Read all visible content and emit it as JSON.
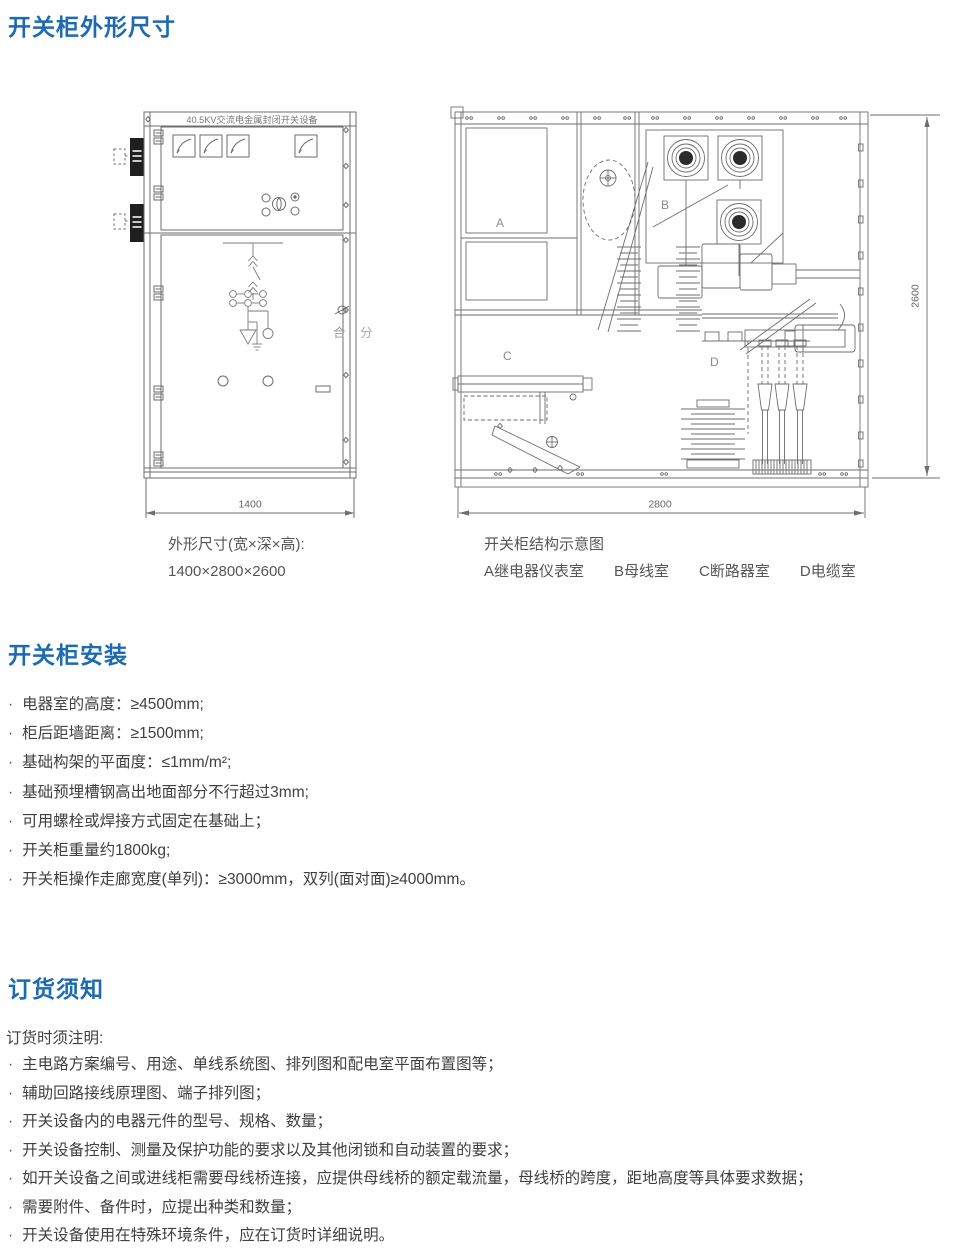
{
  "titles": {
    "outline": "开关柜外形尺寸",
    "installation": "开关柜安装",
    "ordering": "订货须知"
  },
  "bullets": {
    "dot": "·"
  },
  "front_view": {
    "nameplate": "40.5KV交流电金属封闭开关设备",
    "close_label": "合",
    "open_label": "分",
    "width_dim": "1400",
    "caption_line1": "外形尺寸(宽×深×高):",
    "caption_line2": "1400×2800×2600"
  },
  "section_view": {
    "compartments": {
      "a": "A",
      "b": "B",
      "c": "C",
      "d": "D"
    },
    "depth_dim": "2800",
    "height_dim": "2600",
    "caption_title": "开关柜结构示意图",
    "legend": [
      "A继电器仪表室",
      "B母线室",
      "C断路器室",
      "D电缆室"
    ]
  },
  "installation": {
    "items": [
      "电器室的高度：≥4500mm;",
      "柜后距墙距离：≥1500mm;",
      "基础构架的平面度：≤1mm/m²;",
      "基础预埋槽钢高出地面部分不行超过3mm;",
      "可用螺栓或焊接方式固定在基础上；",
      "开关柜重量约1800kg;",
      "开关柜操作走廊宽度(单列)：≥3000mm，双列(面对面)≥4000mm。"
    ]
  },
  "ordering": {
    "intro": "订货时须注明:",
    "items": [
      "主电路方案编号、用途、单线系统图、排列图和配电室平面布置图等；",
      "辅助回路接线原理图、端子排列图；",
      "开关设备内的电器元件的型号、规格、数量；",
      "开关设备控制、测量及保护功能的要求以及其他闭锁和自动装置的要求；",
      "如开关设备之间或进线柜需要母线桥连接，应提供母线桥的额定载流量，母线桥的跨度，距地高度等具体要求数据；",
      "需要附件、备件时，应提出种类和数量；",
      "开关设备使用在特殊环境条件，应在订货时详细说明。"
    ]
  },
  "colors": {
    "heading_blue": "#1d69b2",
    "body_text": "#404040",
    "line_gray": "#6d6d6d"
  }
}
